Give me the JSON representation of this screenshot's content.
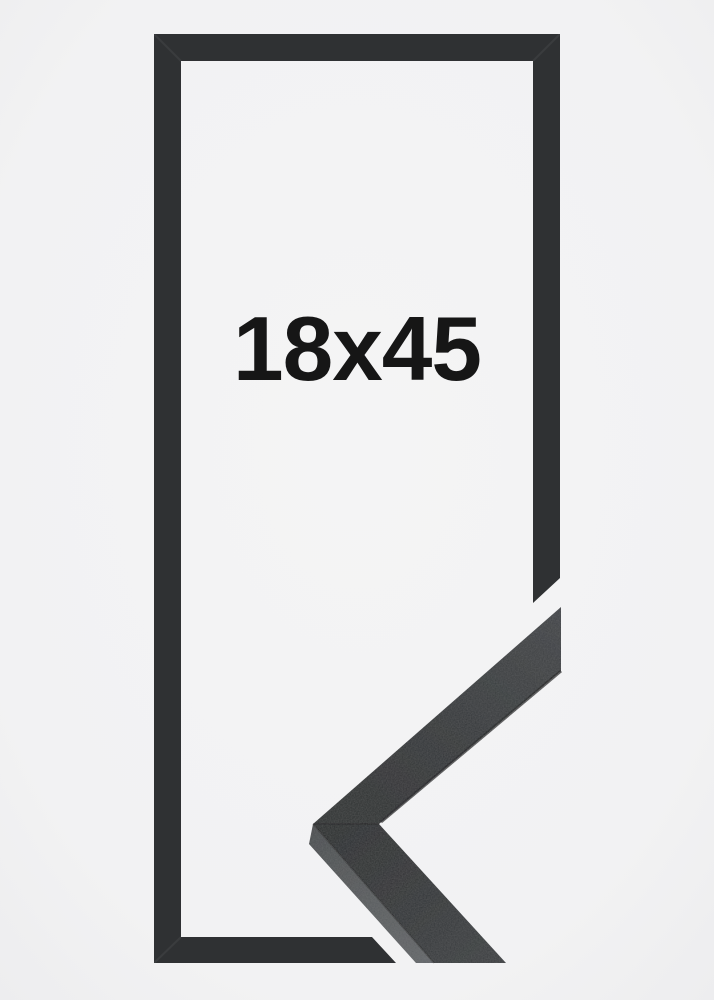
{
  "image": {
    "kind": "product-photo",
    "description": "Flat outline of a tall black picture frame with a photographed moulding corner sample overlapping its lower right corner",
    "size_label": "18x45",
    "colors": {
      "background": "#f1f1f3",
      "background_center": "#f4f4f5",
      "background_edge": "#ececee",
      "frame_outline": "#2f3133",
      "sample_face_tip": "#404346",
      "sample_face_corner": "#2e3032",
      "sample_face_lower": "#3a3d3f",
      "sample_side_light": "#616467",
      "sample_side_dark": "#4b4e50",
      "sample_edge_line": "#17181a",
      "label_text": "#161616"
    }
  }
}
